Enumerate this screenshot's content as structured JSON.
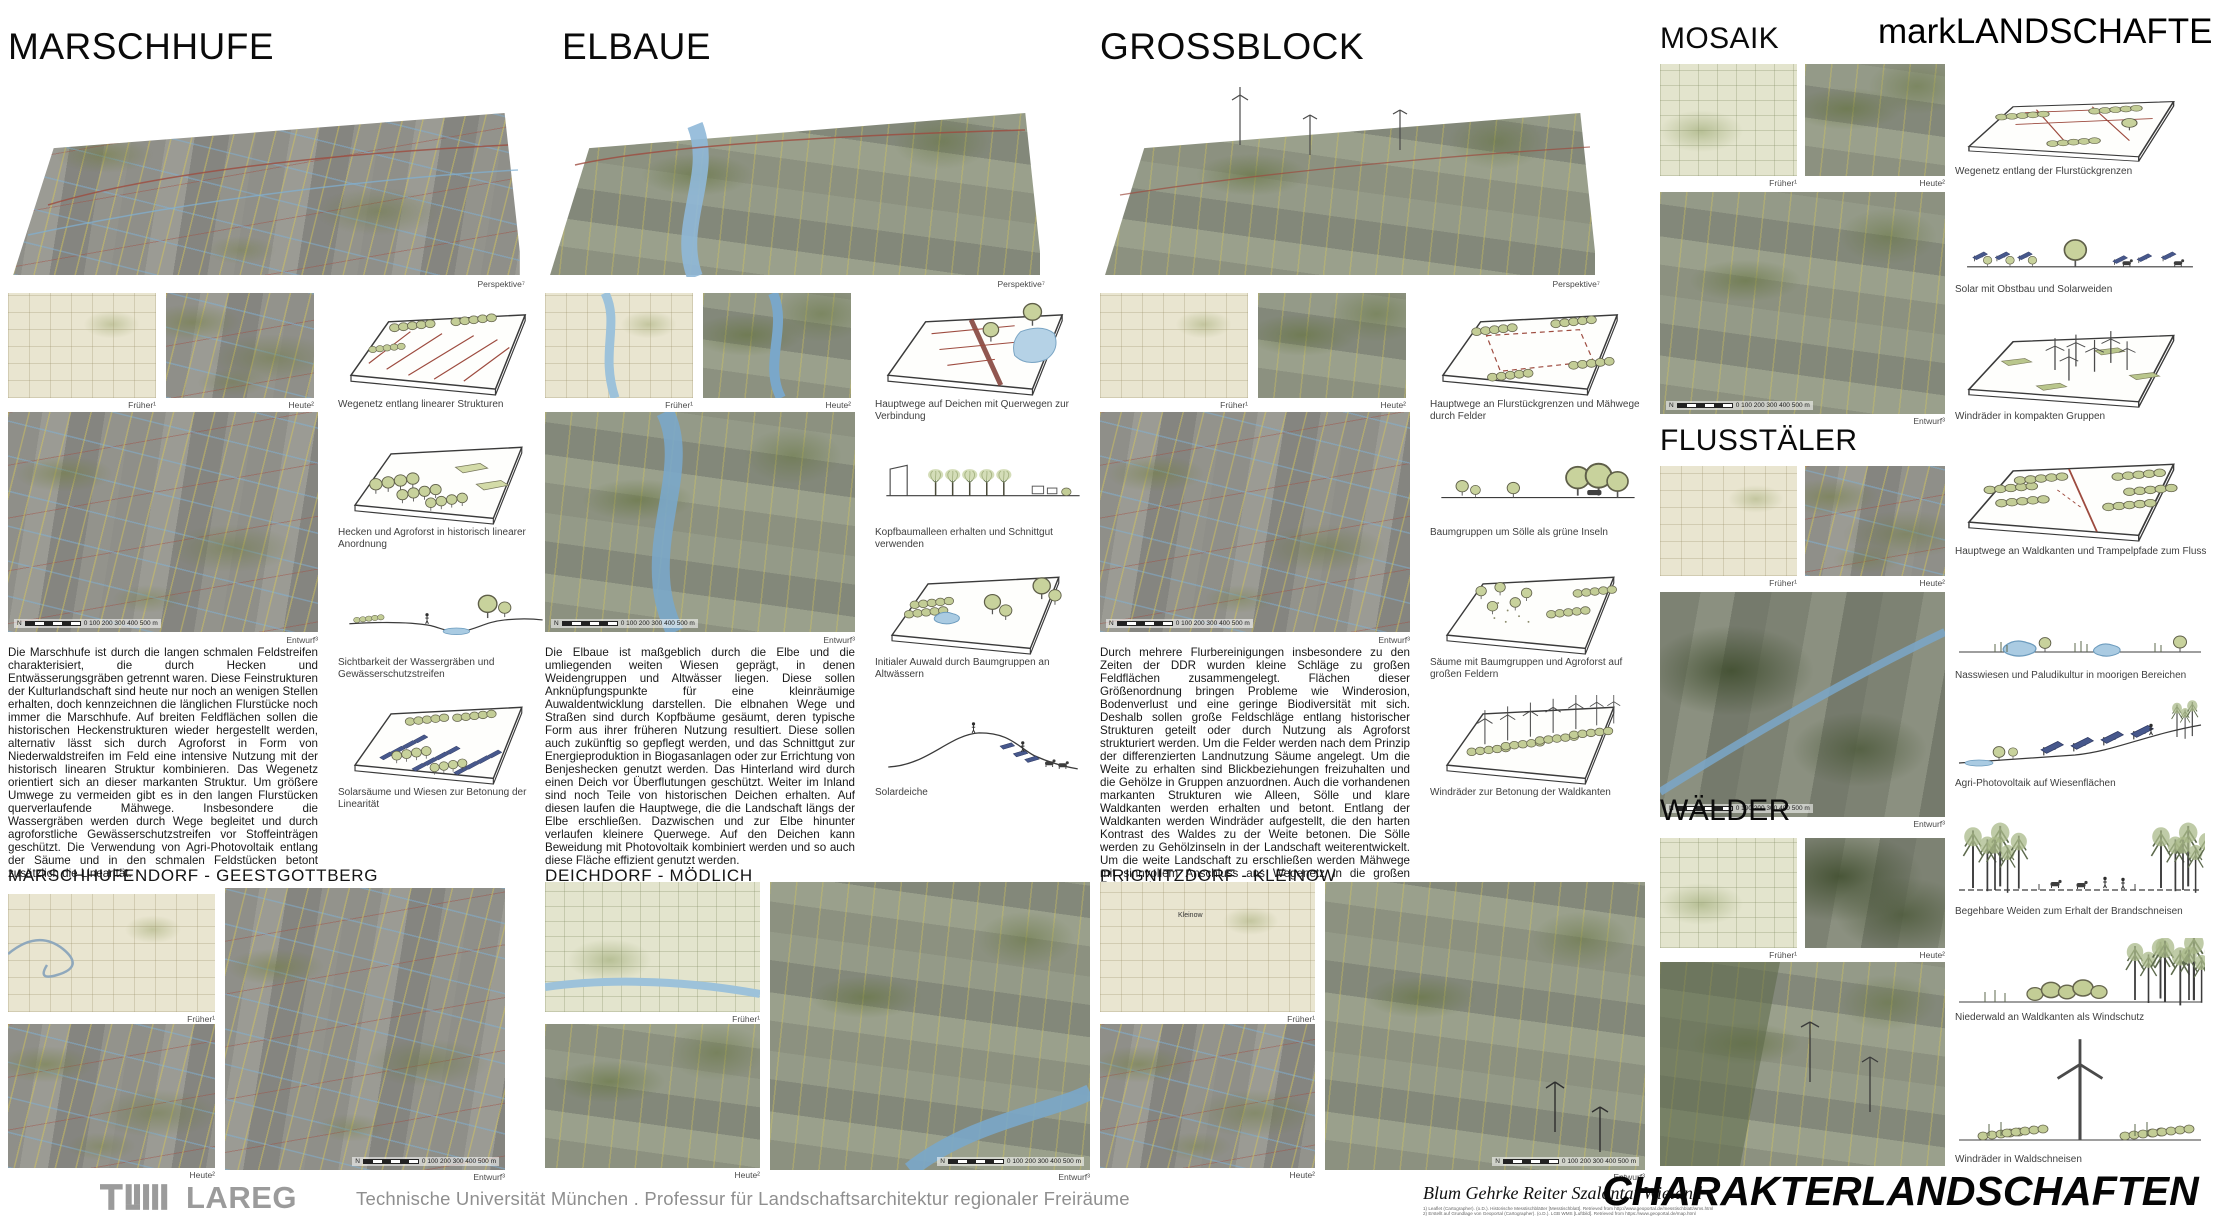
{
  "header": {
    "brand": "markLANDSCHAFTEN"
  },
  "captions": {
    "frueher": "Früher¹",
    "heute": "Heute²",
    "entwurf": "Entwurf³",
    "perspektive": "Perspektive⁷",
    "north": "N",
    "scalebar": "0  100 200 300 400 500 m"
  },
  "columns": [
    {
      "title": "MARSCHHUFE",
      "body": "Die Marschhufe ist durch die langen schmalen Feldstreifen charakterisiert, die durch Hecken und Entwässerungsgräben getrennt waren. Diese Feinstrukturen der Kulturlandschaft sind heute nur noch an wenigen Stellen erhalten, doch kennzeichnen die länglichen Flurstücke noch immer die Marschhufe. Auf breiten Feldflächen sollen die historischen Heckenstrukturen wieder hergestellt werden, alternativ lässt sich durch Agroforst in Form von Niederwaldstreifen im Feld eine intensive Nutzung mit der historisch linearen Struktur kombinieren. Das Wegenetz orientiert sich an dieser markanten Struktur. Um größere Umwege zu vermeiden gibt es in den langen Flurstücken querverlaufende Mähwege. Insbesondere die Wassergräben werden durch Wege begleitet und durch agroforstliche Gewässerschutzstreifen vor Stoffeinträgen geschützt. Die Verwendung von Agri-Photovoltaik entlang der Säume und in den schmalen Feldstücken betont zusätzlich die Linearität.",
      "sketches": [
        {
          "caption": "Wegenetz entlang linearer Strukturen"
        },
        {
          "caption": "Hecken und Agroforst in historisch linearer Anordnung"
        },
        {
          "caption": "Sichtbarkeit der Wassergräben und Gewässerschutzstreifen"
        },
        {
          "caption": "Solarsäume und Wiesen zur Betonung der Linearität"
        }
      ]
    },
    {
      "title": "ELBAUE",
      "body": "Die Elbaue ist maßgeblich durch die Elbe und die umliegenden weiten Wiesen geprägt, in denen Weidengruppen und Altwässer liegen. Diese sollen Anknüpfungspunkte für eine kleinräumige Auwaldentwicklung darstellen. Die elbnahen Wege und Straßen sind durch Kopfbäume gesäumt, deren typische Form aus ihrer früheren Nutzung resultiert. Diese sollen auch zukünftig so gepflegt werden, und das Schnittgut zur Energieproduktion in Biogasanlagen oder zur Errichtung von Benjeshecken genutzt werden. Das Hinterland wird durch einen Deich vor Überflutungen geschützt. Weiter im Inland sind noch Teile von historischen Deichen erhalten. Auf diesen laufen die Hauptwege, die die Landschaft längs der Elbe erschließen. Dazwischen und zur Elbe hinunter verlaufen kleinere Querwege. Auf den Deichen kann Beweidung mit Photovoltaik kombiniert werden und so auch diese Fläche effizient genutzt werden.",
      "sketches": [
        {
          "caption": "Hauptwege auf Deichen mit Querwegen zur Verbindung"
        },
        {
          "caption": "Kopfbaumalleen erhalten und Schnittgut verwenden"
        },
        {
          "caption": "Initialer Auwald durch Baumgruppen an Altwässern"
        },
        {
          "caption": "Solardeiche"
        }
      ]
    },
    {
      "title": "GROSSBLOCK",
      "body": "Durch mehrere Flurbereinigungen insbesondere zu den Zeiten der DDR wurden kleine Schläge zu großen Feldflächen zusammengelegt. Flächen dieser Größenordnung bringen Probleme wie Winderosion, Bodenverlust und eine geringe Biodiversität mit sich. Deshalb sollen große Feldschläge entlang historischer Strukturen geteilt oder durch Nutzung als Agroforst strukturiert werden. Um die Felder werden nach dem Prinzip der differenzierten Landnutzung Säume angelegt. Um die Weite zu erhalten sind Blickbeziehungen freizuhalten und die Gehölze in Gruppen anzuordnen. Auch die vorhandenen markanten Strukturen wie Alleen, Sölle und klare Waldkanten werden erhalten und betont. Entlang der Waldkanten werden Windräder aufgestellt, die den harten Kontrast des Waldes zu der Weite betonen. Die Sölle werden zu Gehölzinseln in der Landschaft weiterentwickelt. Um die weite Landschaft zu erschließen werden Mähwege mit sinnvollem Anschluss ans Wegenetz in die großen Felder gelegt.",
      "sketches": [
        {
          "caption": "Hauptwege an Flurstückgrenzen und Mähwege durch Felder"
        },
        {
          "caption": "Baumgruppen um Sölle als grüne Inseln"
        },
        {
          "caption": "Säume mit Baumgruppen und Agroforst auf großen Feldern"
        },
        {
          "caption": "Windräder zur Betonung der Waldkanten"
        }
      ]
    }
  ],
  "right_sections": [
    {
      "title": "MOSAIK"
    },
    {
      "title": "FLUSSTÄLER"
    },
    {
      "title": "WÄLDER"
    }
  ],
  "right_sketches": [
    {
      "caption": "Wegenetz entlang der Flurstückgrenzen"
    },
    {
      "caption": "Solar mit Obstbau und Solarweiden"
    },
    {
      "caption": "Windräder in kompakten Gruppen"
    },
    {
      "caption": "Hauptwege an Waldkanten und Trampelpfade zum Fluss"
    },
    {
      "caption": "Nasswiesen und Paludikultur in moorigen Bereichen"
    },
    {
      "caption": "Agri-Photovoltaik auf Wiesenflächen"
    },
    {
      "caption": "Begehbare Weiden zum Erhalt der Brandschneisen"
    },
    {
      "caption": "Niederwald an Waldkanten als Windschutz"
    },
    {
      "caption": "Windräder in Waldschneisen"
    }
  ],
  "villages": [
    {
      "title": "MARSCHHUFENDORF - GEESTGOTTBERG",
      "map_label": ""
    },
    {
      "title": "DEICHDORF - MÖDLICH",
      "map_label": ""
    },
    {
      "title": "PRIGNITZDORF - KLEINOW",
      "map_label": "Kleinow"
    }
  ],
  "footer": {
    "tum": "TUM",
    "lareg": "LAREG",
    "affiliation": "Technische Universität München . Professur für Landschaftsarchitektur regionaler Freiräume",
    "authors": "Blum Gehrke Reiter Szalontai Wieland",
    "credits": [
      "1) Leaflet (Cartographer). (o.D.). Historische Messtischblätter [Messtischblatt]. Retrieved from http://www.geoportal.de/messtischblatt/wms.html",
      "2) Erstellt auf Grundlage von Geoportal (Cartographer). (o.D.). LGB WMS [Luftbild]. Retrieved from https://www.geoportal.de/map.html"
    ],
    "series_title": "CHARAKTERLANDSCHAFTEN"
  },
  "colors": {
    "accent_green": "#a9b36e",
    "water_blue": "#8fb8d8",
    "route_red": "#9d4b3f",
    "field_yellow": "#d6c75a",
    "panel_blue": "#47588c",
    "logo_gray": "#9b9b9b"
  }
}
